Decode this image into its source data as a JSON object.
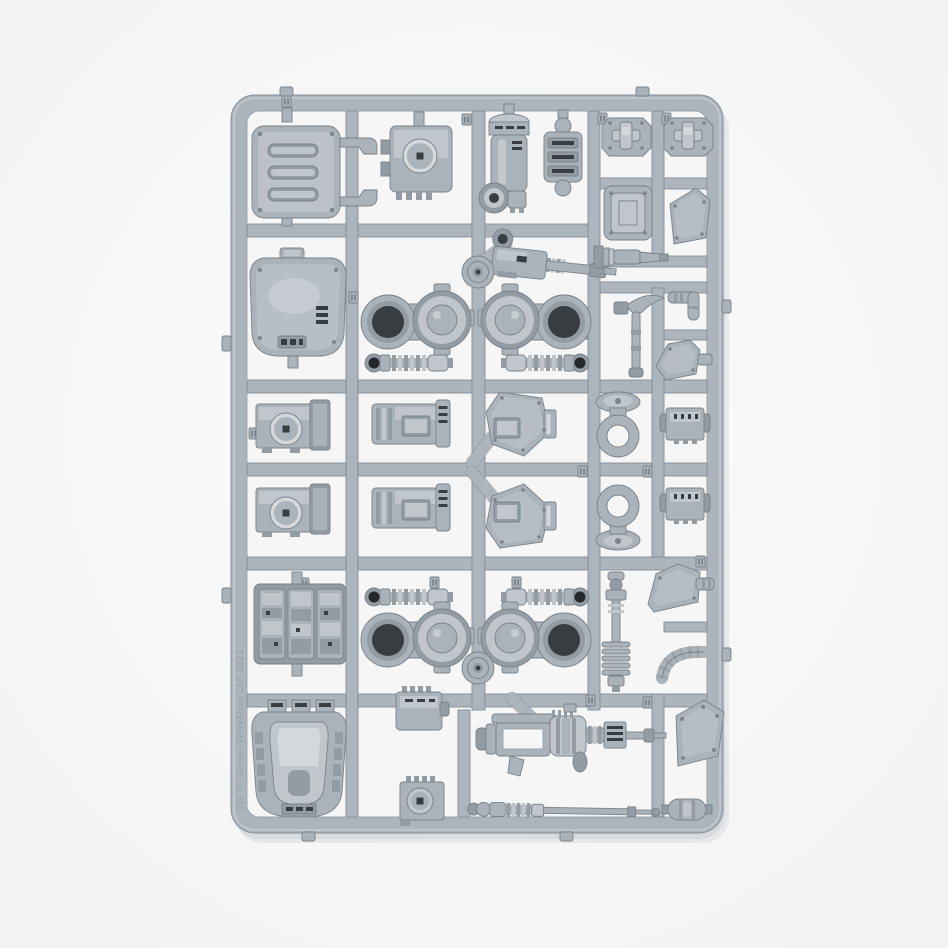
{
  "scene": {
    "type": "product photograph",
    "subject": "Grey polystyrene model-kit sprue frame holding walker vehicle components, photographed on a plain white studio background",
    "background_color": "#f6f7f6",
    "shadow_color": "#707c8c"
  },
  "sprue": {
    "plastic_base_color": "#aab2ba",
    "plastic_light_color": "#c0c6cc",
    "plastic_shade_color": "#939ba3",
    "plastic_edge_color": "#79818a",
    "socket_dark_color": "#383d42",
    "molded_text": "GW © Games Workshop Ltd 2022",
    "grid": {
      "rows": 6,
      "columns": 5
    },
    "parts": [
      {
        "id": "roof-hatch",
        "label": "Vented roof hatch with lever arms"
      },
      {
        "id": "lens-box",
        "label": "Sensor housing with round lens"
      },
      {
        "id": "engine-cylinder",
        "label": "Engine cylinder with ball joint"
      },
      {
        "id": "slat-coupler",
        "label": "Slatted coupler block"
      },
      {
        "id": "foot-pad-left",
        "label": "Octagonal foot pad"
      },
      {
        "id": "foot-pad-right",
        "label": "Octagonal foot pad"
      },
      {
        "id": "square-panel",
        "label": "Riveted square panel"
      },
      {
        "id": "pentagon-plate-small",
        "label": "Riveted pentagonal plate"
      },
      {
        "id": "armored-hatch",
        "label": "Large armoured hatch"
      },
      {
        "id": "autocannon",
        "label": "Autocannon assembly"
      },
      {
        "id": "gun-barrel",
        "label": "Ribbed gun barrel"
      },
      {
        "id": "hip-joint-front-left",
        "label": "Hip joint with disc bearing"
      },
      {
        "id": "hip-joint-front-right",
        "label": "Hip joint with disc bearing, mirrored"
      },
      {
        "id": "piston-front-left",
        "label": "Ribbed piston"
      },
      {
        "id": "piston-front-right",
        "label": "Ribbed piston, mirrored"
      },
      {
        "id": "pick-weapon",
        "label": "Pick weapon"
      },
      {
        "id": "elbow-pipe",
        "label": "Elbow pipe"
      },
      {
        "id": "shoulder-plate",
        "label": "Small shoulder plate"
      },
      {
        "id": "sensor-box-upper",
        "label": "Sensor box with lens"
      },
      {
        "id": "panel-box-upper",
        "label": "Panelled equipment box"
      },
      {
        "id": "knee-plate-upper",
        "label": "Angular knee plate"
      },
      {
        "id": "ring-mount-upper",
        "label": "Ring mount with base disc"
      },
      {
        "id": "vent-box-upper",
        "label": "Small vented box"
      },
      {
        "id": "sensor-box-lower",
        "label": "Sensor box with lens"
      },
      {
        "id": "panel-box-lower",
        "label": "Panelled equipment box"
      },
      {
        "id": "knee-plate-lower",
        "label": "Angular knee plate, mirrored"
      },
      {
        "id": "ring-mount-lower",
        "label": "Ring mount with base disc, mirrored"
      },
      {
        "id": "vent-box-lower",
        "label": "Small vented box"
      },
      {
        "id": "engine-block",
        "label": "Greebled engine block"
      },
      {
        "id": "hip-joint-rear-left",
        "label": "Hip joint with disc bearing"
      },
      {
        "id": "hip-joint-rear-right",
        "label": "Hip joint with disc bearing, mirrored"
      },
      {
        "id": "piston-rear-left",
        "label": "Ribbed piston"
      },
      {
        "id": "piston-rear-right",
        "label": "Ribbed piston, mirrored"
      },
      {
        "id": "piston-column",
        "label": "Vertical ribbed piston column"
      },
      {
        "id": "shoulder-wedge",
        "label": "Angular shoulder wedge"
      },
      {
        "id": "hose-segment",
        "label": "Segmented flexible hose"
      },
      {
        "id": "cockpit-carapace",
        "label": "Cockpit carapace with canopy"
      },
      {
        "id": "small-vent-box",
        "label": "Small vented box"
      },
      {
        "id": "skeleton-gun",
        "label": "Skeletal gun with drum magazine"
      },
      {
        "id": "pentagon-plate-large",
        "label": "Riveted pentagonal plate"
      },
      {
        "id": "lens-box-small",
        "label": "Small lens box"
      },
      {
        "id": "piston-rod",
        "label": "Long piston rod"
      },
      {
        "id": "grenade-pod",
        "label": "Oval pod"
      },
      {
        "id": "hub-upper",
        "label": "Round runner hub"
      },
      {
        "id": "hub-lower",
        "label": "Round runner hub"
      }
    ]
  }
}
